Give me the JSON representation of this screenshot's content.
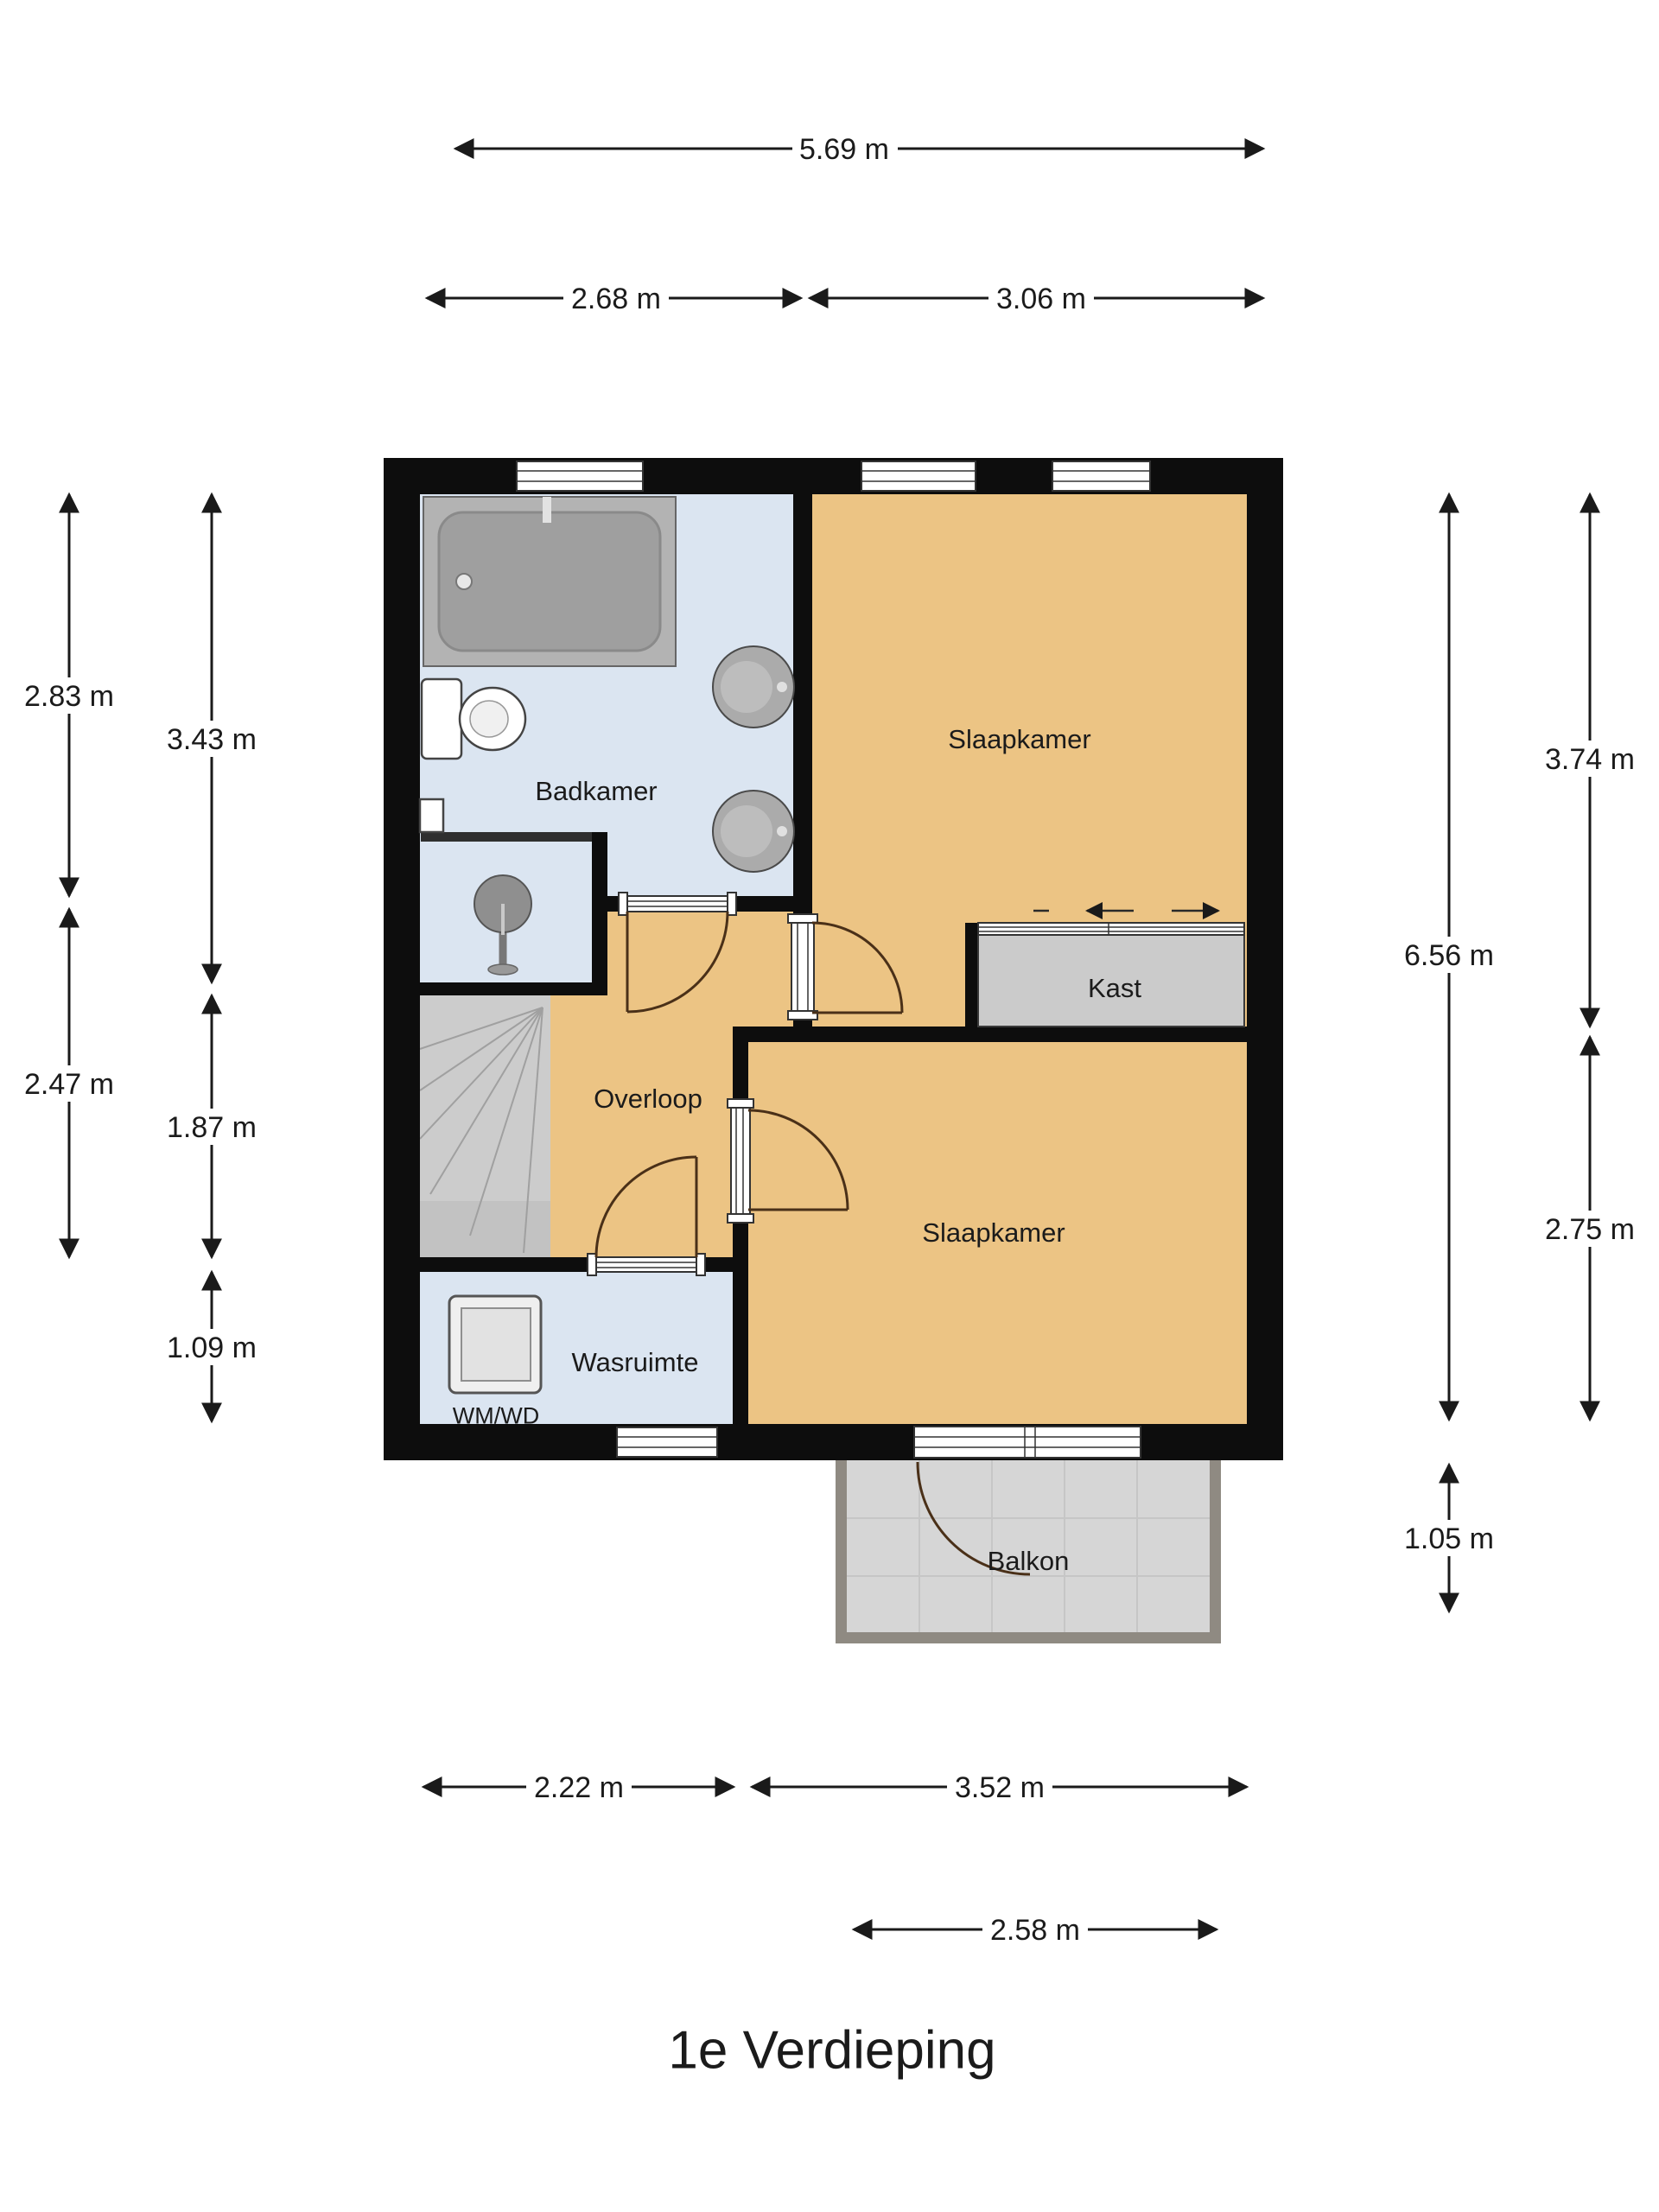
{
  "title": "1e Verdieping",
  "rooms": {
    "badkamer": {
      "label": "Badkamer"
    },
    "slaapkamer_1": {
      "label": "Slaapkamer"
    },
    "kast": {
      "label": "Kast"
    },
    "overloop": {
      "label": "Overloop"
    },
    "slaapkamer_2": {
      "label": "Slaapkamer"
    },
    "wasruimte": {
      "label": "Wasruimte"
    },
    "wasmachine": {
      "label": "WM/WD"
    },
    "balkon": {
      "label": "Balkon"
    }
  },
  "dimensions": {
    "top": [
      {
        "label": "5.69 m"
      },
      {
        "label": "2.68 m"
      },
      {
        "label": "3.06 m"
      }
    ],
    "left": [
      {
        "label": "2.83 m"
      },
      {
        "label": "2.47 m"
      },
      {
        "label": "3.43 m"
      },
      {
        "label": "1.87 m"
      },
      {
        "label": "1.09 m"
      }
    ],
    "right": [
      {
        "label": "6.56 m"
      },
      {
        "label": "3.74 m"
      },
      {
        "label": "2.75 m"
      },
      {
        "label": "1.05 m"
      }
    ],
    "bottom": [
      {
        "label": "2.22 m"
      },
      {
        "label": "3.52 m"
      },
      {
        "label": "2.58 m"
      }
    ]
  },
  "colors": {
    "wall_color": "#0d0d0d",
    "floor_orange": "#ecc484",
    "floor_blue": "#dbe5f1",
    "closet_gray": "#cbcbcb",
    "stairs_gray": "#cccccc",
    "balcony_floor": "#d6d6d6",
    "balcony_wall": "#8f8a82",
    "door_arc": "#4a3018",
    "dim_color": "#1a1a1a",
    "text_color": "#1b1b1b"
  }
}
